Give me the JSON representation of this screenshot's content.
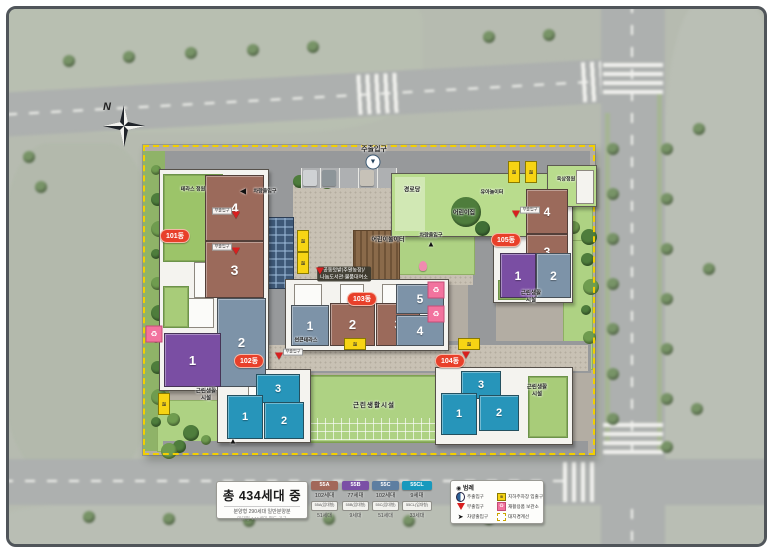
{
  "title_panel": {
    "total": "총 434세대 중",
    "line1": "분양형 290세대 일반분양분",
    "line2": "임대형 144세대 별도 공급"
  },
  "unit_types": [
    {
      "code": "55A",
      "color": "#a2685a",
      "count": "102세대",
      "sub_code": "55A(임대형)",
      "sub_count": "51세대"
    },
    {
      "code": "55B",
      "color": "#7b4fa6",
      "count": "77세대",
      "sub_code": "55B(임대형)",
      "sub_count": "9세대"
    },
    {
      "code": "55C",
      "color": "#5d7ea1",
      "count": "102세대",
      "sub_code": "55C(임대형)",
      "sub_count": "51세대"
    },
    {
      "code": "55CL",
      "color": "#1899bd",
      "count": "9세대",
      "sub_code": "55CL(임대형)",
      "sub_count": "33세대"
    }
  ],
  "legend": {
    "title": "◉ 범례",
    "items": [
      {
        "id": "main-gate",
        "label": "주출입구"
      },
      {
        "id": "sub-gate",
        "label": "부출입구"
      },
      {
        "id": "vehicle-gate",
        "label": "차량출입구"
      },
      {
        "id": "parking-ramp",
        "label": "지하주차장 입출구"
      },
      {
        "id": "recycle",
        "label": "재활용품 보관소"
      },
      {
        "id": "boundary",
        "label": "대지경계선"
      }
    ]
  },
  "compass": "N",
  "colors": {
    "boundary_yellow": "#f2cf00",
    "building_oval_red": "#e8402a",
    "marker_pink": "#f2739e"
  },
  "buildings": [
    {
      "name": "101동",
      "lx": 172,
      "ly": 233,
      "units": [
        {
          "n": "4",
          "type": "55A",
          "x": 202,
          "y": 172,
          "w": 57,
          "h": 64,
          "fs": 14
        },
        {
          "n": "3",
          "type": "55A",
          "x": 202,
          "y": 238,
          "w": 57,
          "h": 55,
          "fs": 14
        },
        {
          "n": "2",
          "type": "55C",
          "x": 214,
          "y": 295,
          "w": 47,
          "h": 87,
          "fs": 13
        },
        {
          "n": "1",
          "type": "55B",
          "x": 161,
          "y": 330,
          "w": 55,
          "h": 52,
          "fs": 13
        }
      ]
    },
    {
      "name": "102동",
      "lx": 246,
      "ly": 358,
      "units": [
        {
          "n": "3",
          "type": "55CL",
          "x": 253,
          "y": 371,
          "w": 42,
          "h": 27,
          "fs": 11
        },
        {
          "n": "1",
          "type": "55CL",
          "x": 224,
          "y": 392,
          "w": 34,
          "h": 42,
          "fs": 11
        },
        {
          "n": "2",
          "type": "55CL",
          "x": 261,
          "y": 399,
          "w": 38,
          "h": 35,
          "fs": 11
        }
      ]
    },
    {
      "name": "103동",
      "lx": 359,
      "ly": 296,
      "units": [
        {
          "n": "1",
          "type": "55C",
          "x": 288,
          "y": 302,
          "w": 36,
          "h": 39,
          "fs": 12
        },
        {
          "n": "2",
          "type": "55A",
          "x": 327,
          "y": 300,
          "w": 43,
          "h": 41,
          "fs": 13
        },
        {
          "n": "3",
          "type": "55A",
          "x": 373,
          "y": 300,
          "w": 42,
          "h": 41,
          "fs": 13
        },
        {
          "n": "5",
          "type": "55C",
          "x": 393,
          "y": 281,
          "w": 46,
          "h": 28,
          "fs": 12
        },
        {
          "n": "4",
          "type": "55C",
          "x": 393,
          "y": 312,
          "w": 46,
          "h": 29,
          "fs": 12
        }
      ]
    },
    {
      "name": "104동",
      "lx": 447,
      "ly": 358,
      "units": [
        {
          "n": "3",
          "type": "55CL",
          "x": 458,
          "y": 368,
          "w": 38,
          "h": 26,
          "fs": 11
        },
        {
          "n": "1",
          "type": "55CL",
          "x": 438,
          "y": 390,
          "w": 34,
          "h": 40,
          "fs": 11
        },
        {
          "n": "2",
          "type": "55CL",
          "x": 476,
          "y": 392,
          "w": 38,
          "h": 34,
          "fs": 11
        }
      ]
    },
    {
      "name": "105동",
      "lx": 503,
      "ly": 237,
      "units": [
        {
          "n": "4",
          "type": "55A",
          "x": 523,
          "y": 186,
          "w": 40,
          "h": 43,
          "fs": 12
        },
        {
          "n": "3",
          "type": "55A",
          "x": 523,
          "y": 231,
          "w": 40,
          "h": 33,
          "fs": 12
        },
        {
          "n": "1",
          "type": "55B",
          "x": 497,
          "y": 250,
          "w": 34,
          "h": 43,
          "fs": 12
        },
        {
          "n": "2",
          "type": "55C",
          "x": 533,
          "y": 250,
          "w": 33,
          "h": 43,
          "fs": 12
        }
      ]
    }
  ],
  "map_labels": [
    {
      "text": "주출입구",
      "x": 371,
      "y": 146,
      "variant": "gate"
    },
    {
      "text": "경로당",
      "x": 409,
      "y": 186,
      "variant": "plain"
    },
    {
      "text": "어린이집",
      "x": 461,
      "y": 209,
      "variant": "plain"
    },
    {
      "text": "유아놀이터",
      "x": 489,
      "y": 189,
      "variant": "tiny"
    },
    {
      "text": "옥상정원",
      "x": 563,
      "y": 176,
      "variant": "tiny"
    },
    {
      "text": "어린이놀이터",
      "x": 385,
      "y": 236,
      "variant": "plain"
    },
    {
      "text": "테라스 정원",
      "x": 190,
      "y": 186,
      "variant": "tiny"
    },
    {
      "text": "공동텃밭(주말농장)/\n나눔도서관·물품대여소",
      "x": 341,
      "y": 271,
      "variant": "dark"
    },
    {
      "text": "썬큰테라스",
      "x": 303,
      "y": 337,
      "variant": "tiny"
    },
    {
      "text": "근린생활시설",
      "x": 371,
      "y": 401,
      "variant": "big"
    },
    {
      "text": "근린생활\n시설",
      "x": 203,
      "y": 392,
      "variant": "two"
    },
    {
      "text": "근린생활\n시설",
      "x": 528,
      "y": 294,
      "variant": "two"
    },
    {
      "text": "근린생활\n시설",
      "x": 534,
      "y": 388,
      "variant": "two"
    }
  ],
  "markers": {
    "main_gate": {
      "x": 370,
      "y": 159
    },
    "sub_gate_label": "부출입구",
    "vehicle_label": "차량출입구",
    "red_triangles": [
      [
        233,
        212
      ],
      [
        233,
        248
      ],
      [
        317,
        268
      ],
      [
        513,
        211
      ],
      [
        276,
        353
      ],
      [
        463,
        352
      ]
    ],
    "sub_gate_chips": [
      [
        219,
        208
      ],
      [
        219,
        244
      ],
      [
        527,
        207
      ],
      [
        290,
        349
      ]
    ],
    "ramps": [
      [
        300,
        238,
        "v"
      ],
      [
        300,
        260,
        "v"
      ],
      [
        511,
        169,
        "v"
      ],
      [
        528,
        169,
        "v"
      ],
      [
        161,
        401,
        "v"
      ],
      [
        352,
        341,
        "h"
      ],
      [
        466,
        341,
        "h"
      ]
    ],
    "pink_boxes": [
      [
        433,
        287
      ],
      [
        433,
        311
      ],
      [
        151,
        331
      ]
    ],
    "vehicle_arrows": [
      {
        "x": 240,
        "y": 188,
        "dir": "left",
        "labeled": true,
        "label_x": 262,
        "label_y": 188
      },
      {
        "x": 428,
        "y": 241,
        "dir": "up",
        "labeled": true,
        "label_x": 428,
        "label_y": 232
      },
      {
        "x": 230,
        "y": 438,
        "dir": "up",
        "labeled": false,
        "label_x": 0,
        "label_y": 0
      }
    ]
  }
}
